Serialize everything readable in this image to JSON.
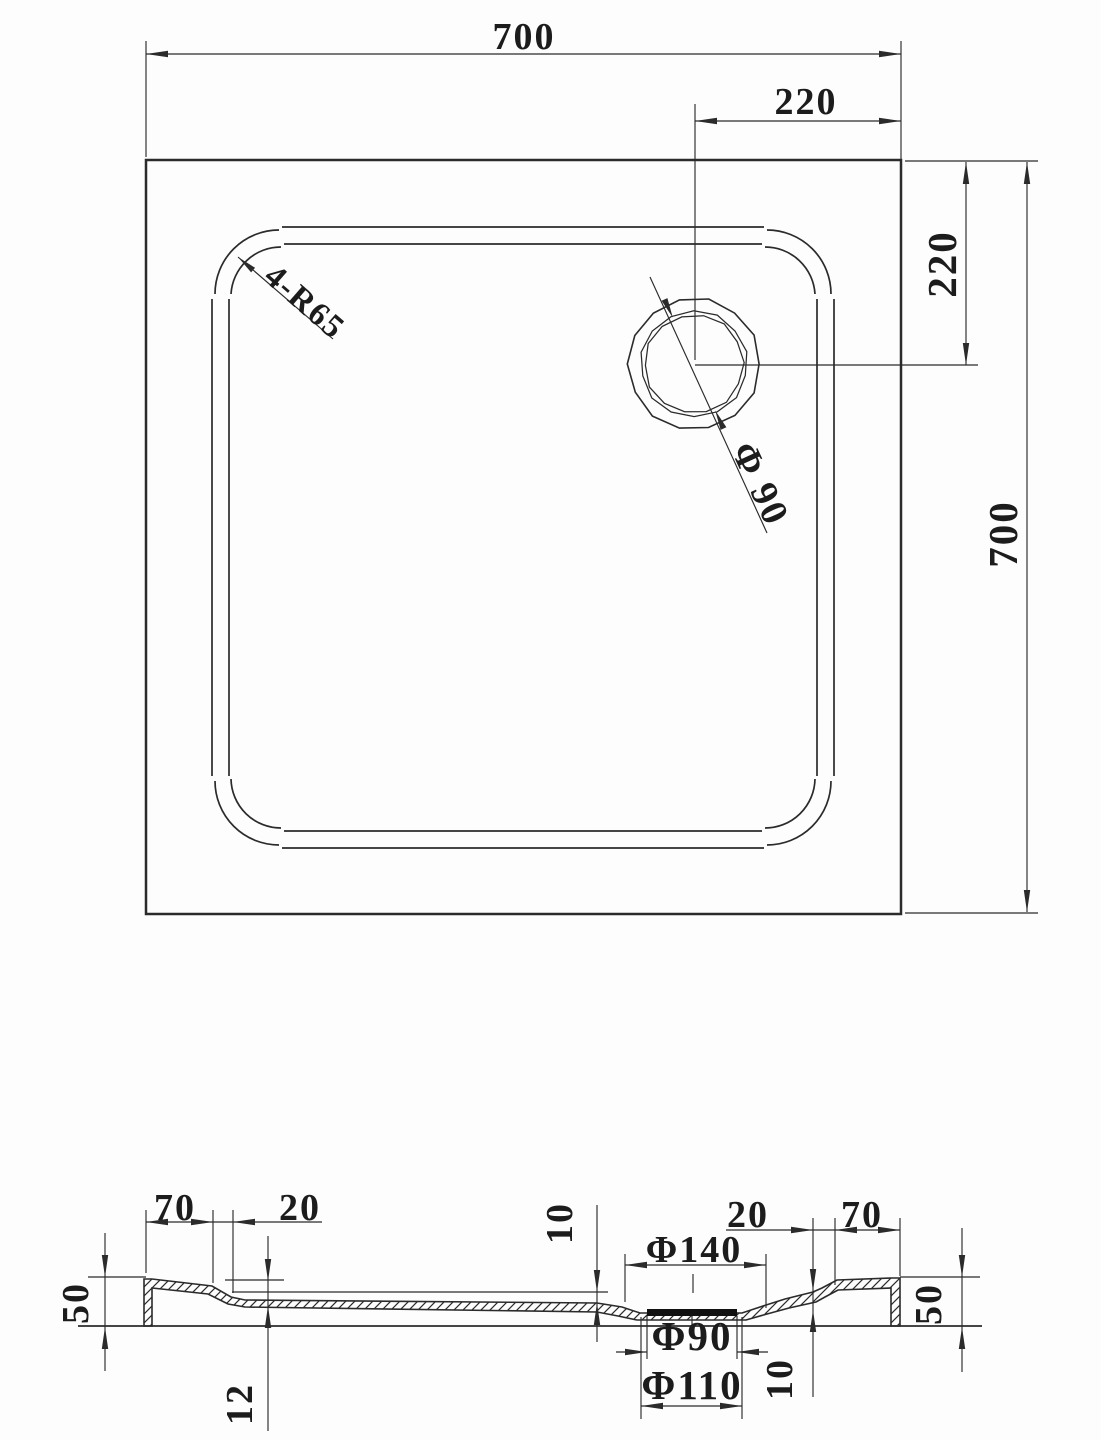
{
  "top_view": {
    "overall_width": "700",
    "overall_height": "700",
    "drain_offset_from_right": "220",
    "drain_offset_from_top": "220",
    "corner_radius_label": "4-R65",
    "drain_diameter_label": "Φ 90"
  },
  "section_view": {
    "left_rim_width": "70",
    "left_step_width": "20",
    "left_edge_height": "50",
    "floor_thickness": "12",
    "left_floor_drop": "10",
    "recess_top_diameter": "Φ140",
    "right_step_width": "20",
    "right_rim_width": "70",
    "right_floor_drop": "10",
    "right_edge_height": "50",
    "drain_hole_diameter": "Φ90",
    "drain_flange_diameter": "Φ110"
  },
  "colors": {
    "line": "#2b2b2b",
    "text": "#1c1c1c",
    "background": "#fdfdfd",
    "drain_bar": "#111111"
  }
}
